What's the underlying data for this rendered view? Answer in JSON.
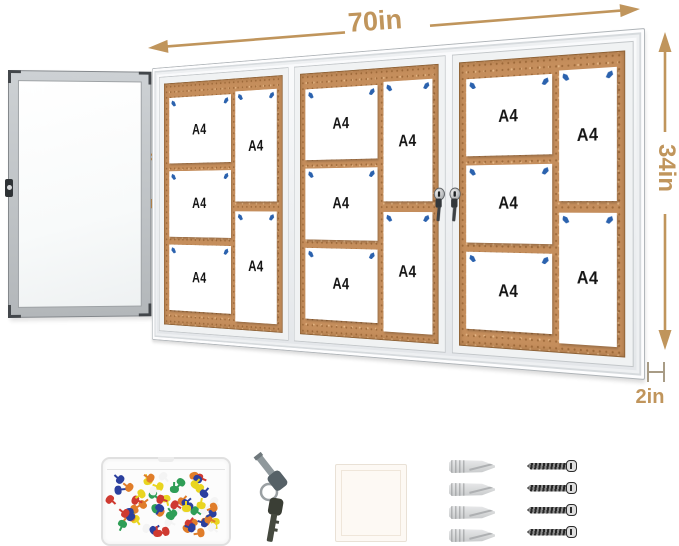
{
  "labels": {
    "width": "70in",
    "height": "34in",
    "depth": "2in",
    "door_swing": "180°"
  },
  "colors": {
    "dimension_annotation": "#c0955c",
    "swing_annotation": "#f6921e",
    "cork": "#c58e5c",
    "board_pin": "#2b62ae",
    "aluminum_frame": "#e9ecee"
  },
  "cabinet": {
    "sections": [
      {
        "papers": [
          {
            "label": "A4"
          },
          {
            "label": "A4"
          },
          {
            "label": "A4"
          },
          {
            "label": "A4"
          },
          {
            "label": "A4"
          }
        ]
      },
      {
        "papers": [
          {
            "label": "A4"
          },
          {
            "label": "A4"
          },
          {
            "label": "A4"
          },
          {
            "label": "A4"
          },
          {
            "label": "A4"
          }
        ]
      },
      {
        "papers": [
          {
            "label": "A4"
          },
          {
            "label": "A4"
          },
          {
            "label": "A4"
          },
          {
            "label": "A4"
          },
          {
            "label": "A4"
          }
        ]
      }
    ],
    "locks_with_keys_count": 2
  },
  "accessories": {
    "push_pin_box": {
      "pin_count": 66,
      "pin_colors": [
        "#cf3a31",
        "#2f9e57",
        "#2b3f9e",
        "#e9d520",
        "#f4f4f4",
        "#e07d2a"
      ]
    },
    "keys_count": 2,
    "anchors_count": 4,
    "screws_count": 4
  }
}
